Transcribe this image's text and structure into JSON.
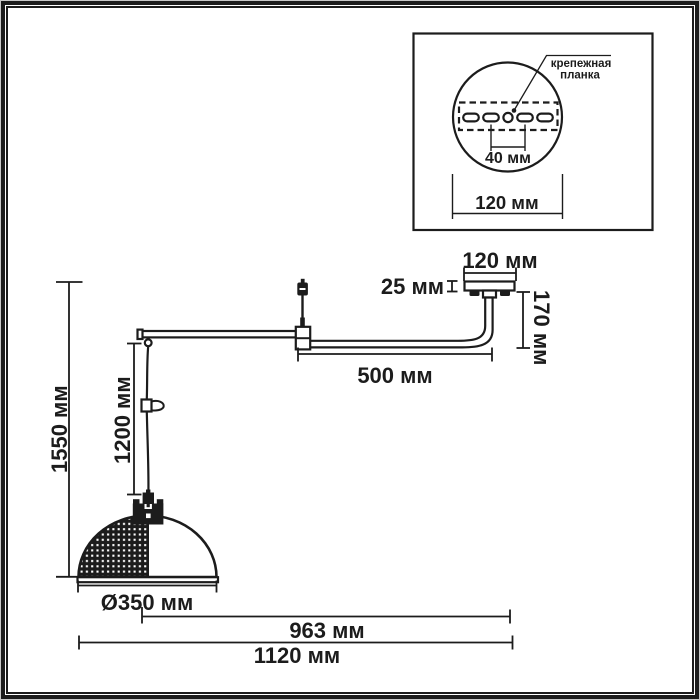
{
  "drawing": {
    "inset": {
      "mounting_plate_label_line1": "крепежная",
      "mounting_plate_label_line2": "планка",
      "hole_spacing": "40 мм",
      "plate_width": "120 мм"
    },
    "dims": {
      "canopy_width": "120 мм",
      "canopy_height": "25 мм",
      "stem_height": "170 мм",
      "arm_length": "500 мм",
      "suspension_length": "1200 мм",
      "overall_height": "1550 мм",
      "shade_diameter": "Ø350 мм",
      "reach_from_shade_center": "963 мм",
      "overall_width": "1120 мм"
    }
  },
  "colors": {
    "ink": "#1c1c1c",
    "paper": "#ffffff"
  }
}
